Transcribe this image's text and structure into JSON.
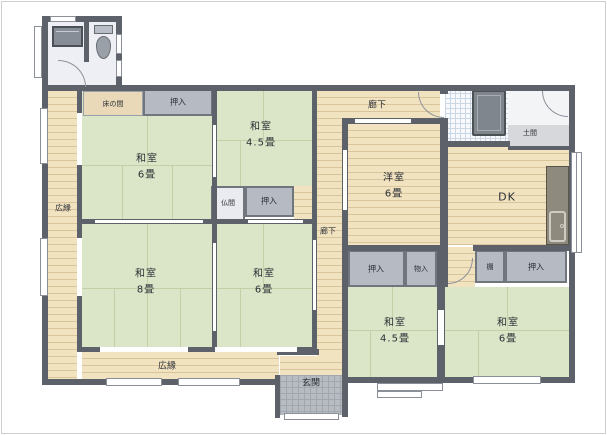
{
  "labels": {
    "tokonoma": "床の間",
    "oshiire": "押入",
    "monoire": "物入",
    "tana": "棚",
    "butsuma": "仏間",
    "rouka": "廊下",
    "hiroen": "広縁",
    "genkan": "玄関",
    "doma": "土間",
    "dk": "DK"
  },
  "rooms": {
    "tl6": {
      "type": "和室",
      "size": "6畳"
    },
    "top45": {
      "type": "和室",
      "size": "4.5畳"
    },
    "w8": {
      "type": "和室",
      "size": "8畳"
    },
    "bm6": {
      "type": "和室",
      "size": "6畳"
    },
    "yo6": {
      "type": "洋室",
      "size": "6畳"
    },
    "br45": {
      "type": "和室",
      "size": "4.5畳"
    },
    "br6": {
      "type": "和室",
      "size": "6畳"
    }
  },
  "colors": {
    "wall": "#5d626a",
    "tatami": "#dbe5c8",
    "tatami_line": "#c2d0a8",
    "wood": "#f1e2c0",
    "wood_line": "#d9c59b",
    "closet": "#b5bac3",
    "closet_border": "#71767e",
    "bath_tile": "#f7f9fc",
    "bath_grid": "#ccd7e6",
    "genkan_tile": "#b7bbc2",
    "genkan_grid": "#a2a7af",
    "sanitary_floor": "#edeff4",
    "doma": "#d6d8db",
    "counter": "#8e8b7e",
    "tub": "#80868e",
    "label": "#2b2f35",
    "window_border": "#8b9098"
  }
}
